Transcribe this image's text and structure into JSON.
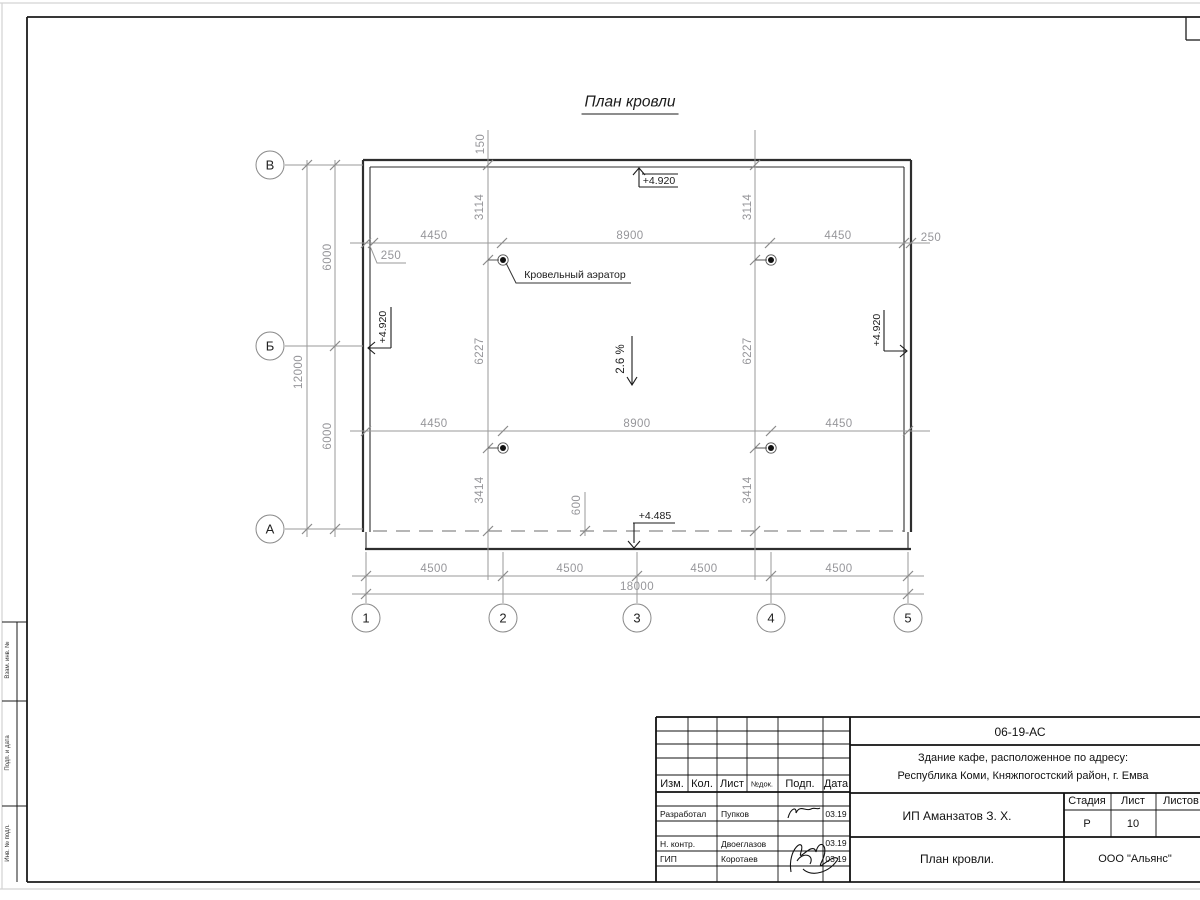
{
  "drawing": {
    "title": "План кровли",
    "slope": "2.6 %",
    "aerator_label": "Кровельный аэратор",
    "elevation_top": "+4.920",
    "elevation_left": "+4.920",
    "elevation_right": "+4.920",
    "elevation_bottom": "+4.485",
    "axes": {
      "rows": [
        "В",
        "Б",
        "А"
      ],
      "cols": [
        "1",
        "2",
        "3",
        "4",
        "5"
      ]
    },
    "dims": {
      "row1": [
        "4450",
        "8900",
        "4450"
      ],
      "row2": [
        "4450",
        "8900",
        "4450"
      ],
      "offset_left": "250",
      "offset_right": "250",
      "offset_top": "150",
      "offset_bottom": "600",
      "col_left": [
        "3114",
        "6227",
        "3414"
      ],
      "col_right": [
        "3114",
        "6227",
        "3414"
      ],
      "bottom_row": [
        "4500",
        "4500",
        "4500",
        "4500"
      ],
      "bottom_total": "18000",
      "left_col": [
        "6000",
        "6000"
      ],
      "left_total": "12000"
    }
  },
  "side_stamp": {
    "labels": [
      "Взам. инв. №",
      "Подп. и дата",
      "Инв. № подл."
    ]
  },
  "titleblock": {
    "doc_number": "06-19-АС",
    "project_line1": "Здание кафе, расположенное по адресу:",
    "project_line2": "Республика Коми, Княжпогостский район, г. Емва",
    "client": "ИП Аманзатов З. Х.",
    "sheet_title": "План кровли.",
    "company": "ООО \"Альянс\"",
    "stage_label": "Стадия",
    "sheet_label": "Лист",
    "sheets_label": "Листов",
    "stage_value": "Р",
    "sheet_value": "10",
    "header": {
      "izm": "Изм.",
      "kol": "Кол.",
      "list": "Лист",
      "ndok": "№док.",
      "podp": "Подп.",
      "data": "Дата"
    },
    "roles": [
      {
        "role": "Разработал",
        "name": "Пупков",
        "date": "03.19"
      },
      {
        "role": "Н. контр.",
        "name": "Двоеглазов",
        "date": "03.19"
      },
      {
        "role": "ГИП",
        "name": "Коротаев",
        "date": "03.19"
      }
    ]
  }
}
